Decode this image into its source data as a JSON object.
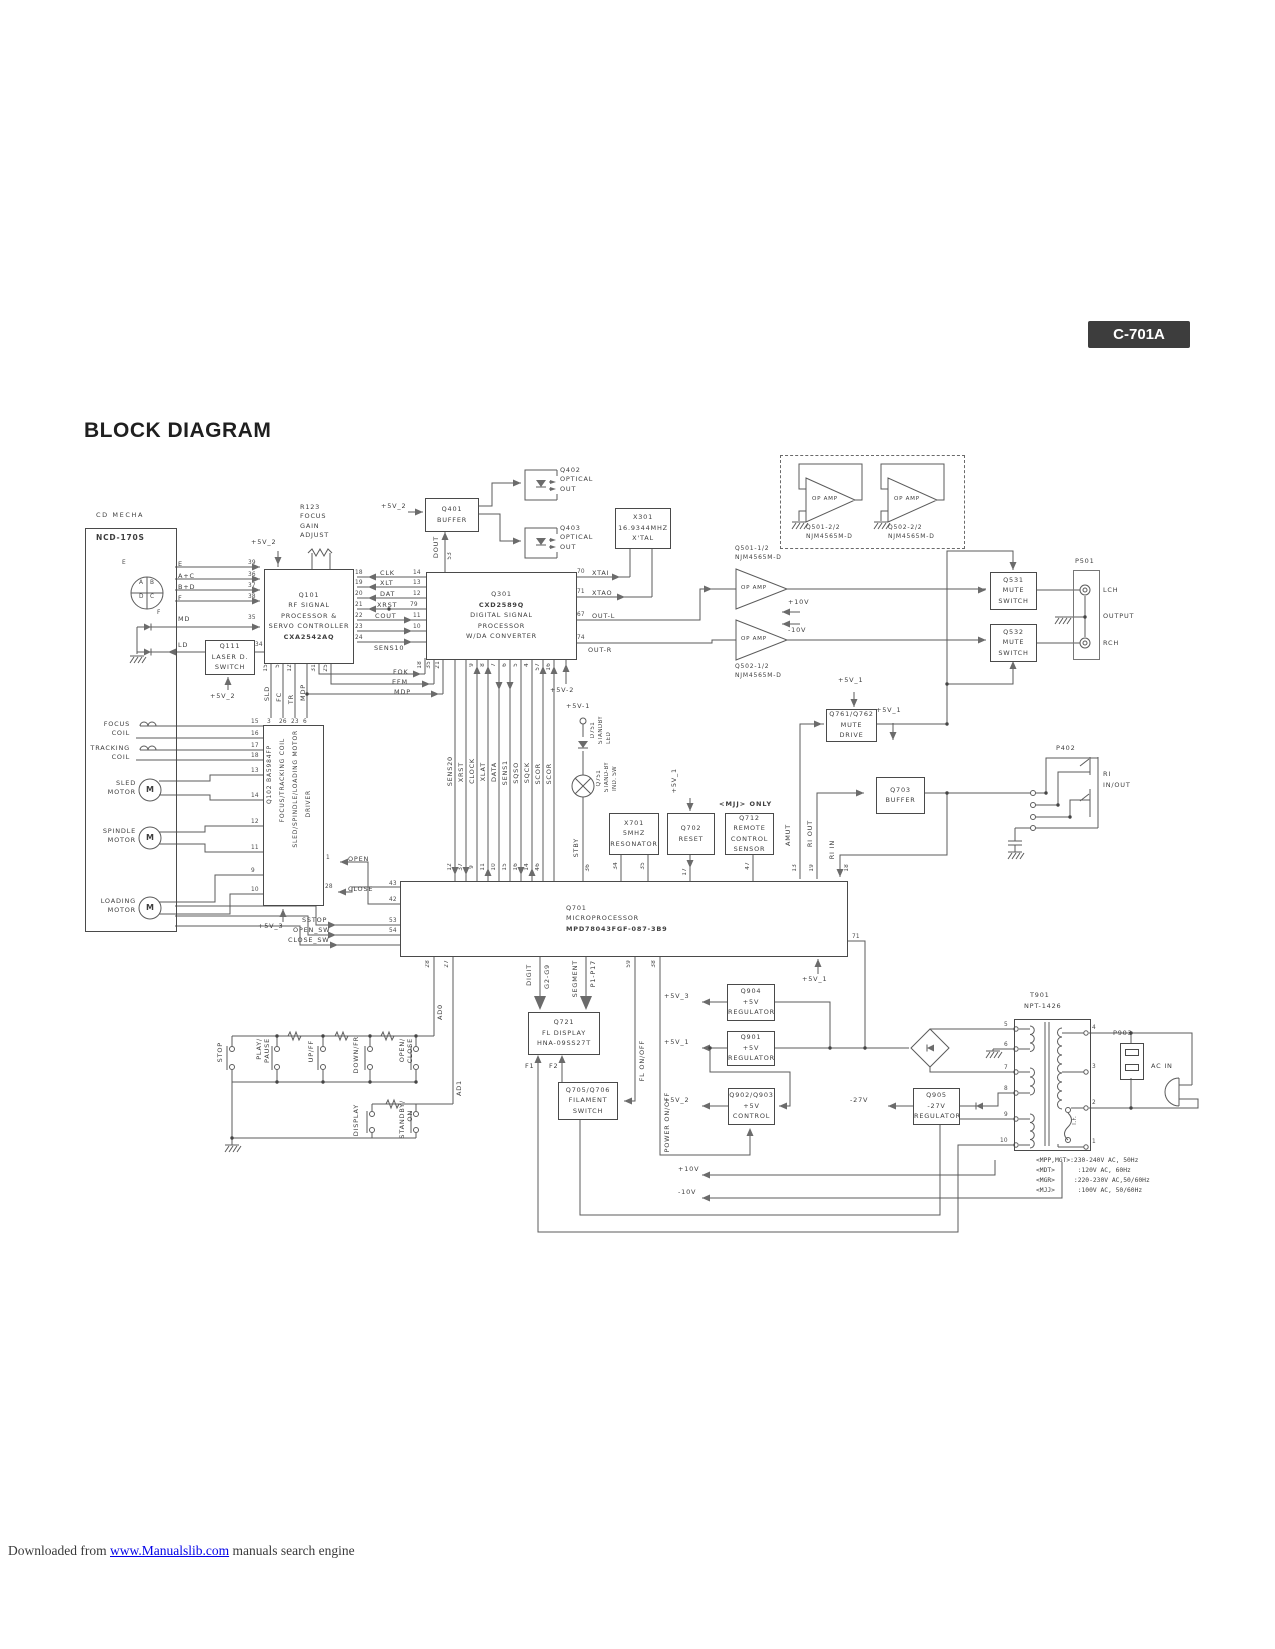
{
  "page": {
    "badge": "C-701A",
    "title": "BLOCK DIAGRAM",
    "footer_prefix": "Downloaded from ",
    "footer_link": "www.Manualslib.com",
    "footer_suffix": " manuals search engine"
  },
  "supplies": {
    "v1": "+5V_1",
    "v2": "+5V_2",
    "v3": "+5V_3",
    "v1d": "+5V-1",
    "v2d": "+5V-2",
    "p10": "+10V",
    "m10": "-10V",
    "m27": "-27V"
  },
  "mecha": {
    "heading": "CD MECHA",
    "model": "NCD-170S",
    "pd": {
      "a": "A",
      "b": "B",
      "d": "D",
      "c": "C",
      "e": "E",
      "f": "F"
    },
    "sig": [
      "E",
      "A+C",
      "B+D",
      "F",
      "MD",
      "LD"
    ],
    "sig_pins": [
      "39",
      "36",
      "37",
      "38",
      "35",
      "34"
    ],
    "parts": [
      [
        "FOCUS",
        "COIL"
      ],
      [
        "TRACKING",
        "COIL"
      ],
      [
        "SLED",
        "MOTOR"
      ],
      [
        "SPINDLE",
        "MOTOR"
      ],
      [
        "LOADING",
        "MOTOR"
      ]
    ],
    "motor": "M",
    "part_pins": [
      "15",
      "16",
      "17",
      "18",
      "13",
      "14",
      "12",
      "11",
      "9",
      "10"
    ],
    "sw": [
      "SSTOP",
      "OPEN_SW",
      "CLOSE_SW"
    ]
  },
  "q111": {
    "lines": [
      "Q111",
      "LASER D.",
      "SWITCH"
    ]
  },
  "r123": {
    "lines": [
      "R123",
      "FOCUS",
      "GAIN",
      "ADJUST"
    ]
  },
  "q101": {
    "lines": [
      "Q101",
      "RF SIGNAL",
      "PROCESSOR &",
      "SERVO CONTROLLER",
      "CXA2542AQ"
    ],
    "right_pins": [
      "18",
      "19",
      "20",
      "21",
      "22",
      "23",
      "24"
    ],
    "bottom_pins": [
      "15",
      "5",
      "12",
      "31",
      "25"
    ],
    "bottom_sigs": [
      "SLD",
      "FC",
      "TR",
      "MDP"
    ]
  },
  "q102": {
    "cols": [
      "Q102   BA5984FP",
      "FOCUS/TRACKING COIL",
      "SLED/SPINDLE/LOADING MOTOR",
      "DRIVER"
    ],
    "top_pins": [
      "3",
      "26",
      "23",
      "6"
    ],
    "open": "OPEN",
    "open_pin": "1",
    "close": "CLOSE",
    "close_pin": "28"
  },
  "serial": {
    "labels": [
      "CLK",
      "XLT",
      "DAT",
      "XRST",
      "COUT"
    ],
    "sens10": "SENS10",
    "q301_pins": [
      "14",
      "13",
      "12",
      "79",
      "11",
      "10"
    ],
    "dout": "DOUT",
    "dout_pin": "53"
  },
  "q401": {
    "lines": [
      "Q401",
      "BUFFER"
    ]
  },
  "q402": {
    "lines": [
      "Q402",
      "OPTICAL",
      "OUT"
    ]
  },
  "q403": {
    "lines": [
      "Q403",
      "OPTICAL",
      "OUT"
    ]
  },
  "x301": {
    "lines": [
      "X301",
      "16.9344MHZ",
      "X'TAL"
    ]
  },
  "q301": {
    "lines": [
      "Q301",
      "CXD2589Q",
      "DIGITAL SIGNAL",
      "PROCESSOR",
      "W/DA CONVERTER"
    ],
    "out": [
      [
        "XTAI",
        "70"
      ],
      [
        "XTAO",
        "71"
      ],
      [
        "OUT-L",
        "67"
      ],
      [
        "OUT-R",
        "74"
      ]
    ],
    "fem": [
      "FOK",
      "EFM",
      "MDP"
    ],
    "fem_pins": [
      "18",
      "35",
      "21"
    ],
    "bus_pins": [
      "9",
      "8",
      "7",
      "6",
      "5",
      "4",
      "57",
      "16"
    ]
  },
  "bus": {
    "labels": [
      "SENS20",
      "XRST",
      "CLOCK",
      "XLAT",
      "DATA",
      "SENS1",
      "SQSO",
      "SQCK",
      "SCOR",
      "SCOR"
    ],
    "q701_pins": [
      "12",
      "37",
      "9",
      "11",
      "10",
      "15",
      "16",
      "14",
      "46"
    ]
  },
  "standby": {
    "d751": [
      "D751",
      "STANDBY",
      "LED"
    ],
    "q751": [
      "Q751",
      "STAND-BY",
      "IND. SW"
    ],
    "stby": "STBY",
    "pin": "36"
  },
  "x701": {
    "lines": [
      "X701",
      "5MHZ",
      "RESONATOR"
    ],
    "pins": [
      "34",
      "35"
    ]
  },
  "q702": {
    "lines": [
      "Q702",
      "RESET"
    ],
    "pin": "17"
  },
  "q712": {
    "lines": [
      "Q712",
      "REMOTE",
      "CONTROL",
      "SENSOR"
    ],
    "pin": "47",
    "note": "<MJJ> ONLY"
  },
  "q701": {
    "lines": [
      "Q701",
      "MICROPROCESSOR",
      "MPD78043FGF-087-3B9"
    ],
    "left_pins": [
      "43",
      "42",
      "53",
      "54"
    ],
    "amut": "AMUT",
    "amut_pin": "13",
    "ri_out": "RI OUT",
    "ri_out_pin": "19",
    "ri_in": "RI IN",
    "ri_in_pin": "18",
    "pin71": "71",
    "ad0": "AD0",
    "ad0_pin": "28",
    "ad1": "AD1",
    "ad1_pin": "27"
  },
  "opamp": {
    "label": "OP AMP",
    "q501_1": [
      "Q501-1/2",
      "NJM4565M-D"
    ],
    "q502_1": [
      "Q502-1/2",
      "NJM4565M-D"
    ],
    "q501_2": [
      "Q501-2/2",
      "NJM4565M-D"
    ],
    "q502_2": [
      "Q502-2/2",
      "NJM4565M-D"
    ]
  },
  "q531": {
    "lines": [
      "Q531",
      "MUTE",
      "SWITCH"
    ]
  },
  "q532": {
    "lines": [
      "Q532",
      "MUTE",
      "SWITCH"
    ]
  },
  "p501": {
    "label": "P501",
    "lch": "LCH",
    "output": "OUTPUT",
    "rch": "RCH"
  },
  "q761": {
    "lines": [
      "Q761/Q762",
      "MUTE",
      "DRIVE"
    ]
  },
  "q703": {
    "lines": [
      "Q703",
      "BUFFER"
    ]
  },
  "p402": {
    "label": "P402",
    "ri": "RI",
    "inout": "IN/OUT"
  },
  "buttons": {
    "stop": "STOP",
    "play": [
      "PLAY/",
      "PAUSE"
    ],
    "upff": "UP/FF",
    "downfr": "DOWN/FR",
    "openclose": [
      "OPEN/",
      "CLOSE"
    ],
    "display": "DISPLAY",
    "standby": [
      "STANDBY/",
      "ON"
    ]
  },
  "fl": {
    "q721": [
      "Q721",
      "FL DISPLAY",
      "HNA-09SS27T"
    ],
    "digit": "DIGIT",
    "g": "G2-G9",
    "segment": "SEGMENT",
    "pp": "P1-P17",
    "f1": "F1",
    "f2": "F2",
    "flonoff": "FL ON/OFF",
    "pin59": "59",
    "power": "POWER ON/OFF",
    "pin38": "38"
  },
  "q705": {
    "lines": [
      "Q705/Q706",
      "FILAMENT",
      "SWITCH"
    ]
  },
  "q904": {
    "lines": [
      "Q904",
      "+5V",
      "REGULATOR"
    ]
  },
  "q901": {
    "lines": [
      "Q901",
      "+5V",
      "REGULATOR"
    ]
  },
  "q902": {
    "lines": [
      "Q902/Q903",
      "+5V",
      "CONTROL"
    ]
  },
  "q905": {
    "lines": [
      "Q905",
      "-27V",
      "REGULATOR"
    ]
  },
  "t901": {
    "name": "T901",
    "model": "NPT-1426",
    "tf": "T.F.",
    "pins_left": [
      "5",
      "6",
      "7",
      "8",
      "9",
      "10"
    ],
    "pins_right": [
      "4",
      "3",
      "2",
      "1"
    ]
  },
  "p903": {
    "label": "P903"
  },
  "ac": {
    "label": "AC IN"
  },
  "mains": [
    "<MPP,MGT>:230-240V AC, 50Hz",
    "<MDT>      :120V AC, 60Hz",
    "<MGR>     :220-230V AC,50/60Hz",
    "<MJJ>      :100V AC, 50/60Hz"
  ]
}
